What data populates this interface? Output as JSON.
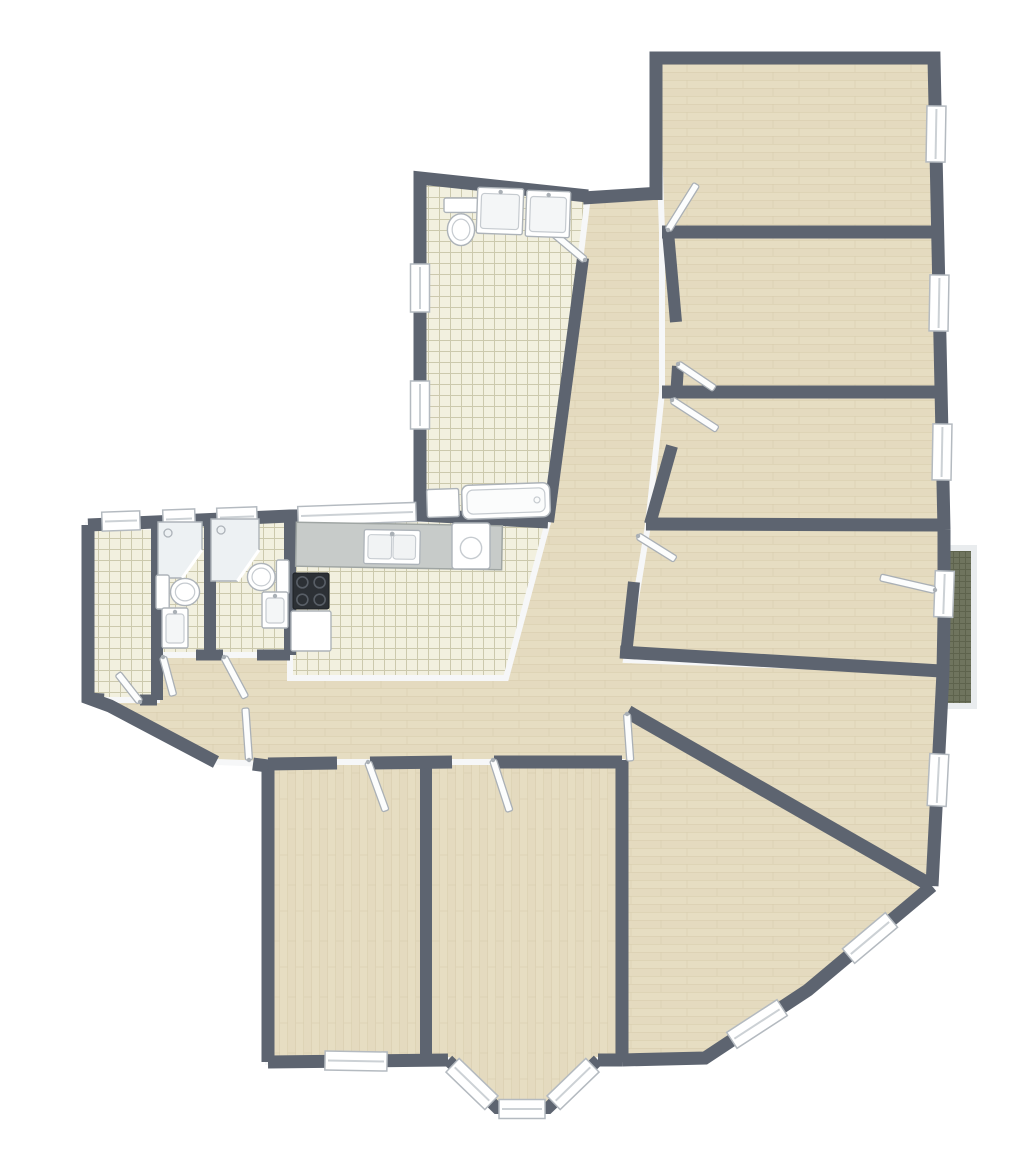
{
  "canvas": {
    "width": 1023,
    "height": 1171
  },
  "palette": {
    "bg": "#ffffff",
    "wall": "#5d6470",
    "baseboard": "#f6f7f8",
    "woodBase": "#e6ddc2",
    "woodLine": "#d6cbac",
    "tileBase": "#f2f0df",
    "tileLine": "#c8c4a8",
    "balconyBase": "#6f745e",
    "balconyLine": "#5e634d",
    "railing": "#e9ecee",
    "windowFill": "#ffffff",
    "windowFrame": "#b4bac0",
    "windowSill": "#ccd1d5",
    "doorFill": "#fcfdfd",
    "doorFrame": "#aab0b6",
    "fixtureFill": "#ffffff",
    "fixtureStroke": "#adb3b9",
    "fixtureDetail": "#c6cbd0",
    "showerFill": "#edf1f3",
    "counter": "#c7cbc9",
    "counterEdge": "#9fa5a3",
    "cooktop": "#2c3035",
    "cooktopRing": "#585e66"
  },
  "floorplan": {
    "rooms": [
      {
        "name": "hallway-living-open-area",
        "floor": "woodH",
        "points": "420,178 588,196 661,193 668,232 676,322 678,366 676,398 668,450 648,530 626,651 941,671 941,712 932,886 808,990 705,1058 598,1060 548,1108 497,1108 448,1060 268,1062 268,764 218,762 110,706 88,700 88,525 157,522 290,516 420,515"
      },
      {
        "name": "bedroom-left",
        "floor": "woodV",
        "points": "268,762 426,762 426,1062 268,1062"
      },
      {
        "name": "bedroom-middle-bay",
        "floor": "woodV",
        "points": "426,762 622,762 622,1060 598,1060 548,1108 497,1108 448,1060 426,1060"
      },
      {
        "name": "room-top-1",
        "floor": "woodH",
        "points": "656,58 934,58 938,232 662,232"
      },
      {
        "name": "room-top-2",
        "floor": "woodH",
        "points": "662,232 938,232 941,392 662,392"
      },
      {
        "name": "room-top-3",
        "floor": "woodH",
        "points": "662,392 941,392 943,525 648,525"
      },
      {
        "name": "room-top-4",
        "floor": "woodH",
        "points": "648,525 943,525 941,671 626,660"
      },
      {
        "name": "bathroom-main",
        "floor": "tile",
        "points": "420,178 588,196 548,522 420,515"
      },
      {
        "name": "utility-room",
        "floor": "tile",
        "points": "88,525 157,527 157,700 88,700"
      },
      {
        "name": "wc-shower-1",
        "floor": "tile",
        "points": "157,521 210,521 210,655 157,655"
      },
      {
        "name": "wc-shower-2",
        "floor": "tile",
        "points": "210,518 290,518 290,655 210,655"
      },
      {
        "name": "kitchen",
        "floor": "tile",
        "points": "290,516 548,522 506,678 290,678"
      }
    ],
    "balcony": {
      "floor": "944,548 974,548 974,706 944,706",
      "railing": "946,548 974,548 974,706 946,706"
    },
    "walls": [
      {
        "name": "ext-bathroom-left-top",
        "w": 13,
        "points": "420,515 420,178 588,196"
      },
      {
        "name": "ext-corridor-top",
        "w": 13,
        "points": "583,198 661,193"
      },
      {
        "name": "ext-rooms-top-right",
        "w": 13,
        "points": "656,200 656,58 934,58 944,530"
      },
      {
        "name": "ext-room4-right-a",
        "w": 13,
        "points": "944,530 944,572"
      },
      {
        "name": "ext-room4-right-b",
        "w": 13,
        "points": "944,617 943,672 941,712 932,886"
      },
      {
        "name": "ext-living-chamfers",
        "w": 13,
        "points": "932,886 808,990 705,1058 622,1060"
      },
      {
        "name": "ext-bed-mid-bottom-right",
        "w": 13,
        "points": "622,1060 598,1060"
      },
      {
        "name": "ext-bay",
        "w": 12,
        "points": "598,1060 548,1108 497,1108 448,1060"
      },
      {
        "name": "ext-bed-left-bottom",
        "w": 13,
        "points": "448,1060 268,1062"
      },
      {
        "name": "ext-bed-left-left",
        "w": 13,
        "points": "268,1062 268,764"
      },
      {
        "name": "ext-hall-stub",
        "w": 13,
        "points": "268,766 253,764"
      },
      {
        "name": "ext-entry-left",
        "w": 13,
        "points": "216,762 110,706 88,698 88,525"
      },
      {
        "name": "ext-top-left",
        "w": 13,
        "points": "88,525 290,516 420,515"
      },
      {
        "name": "int-utility-right",
        "w": 12,
        "points": "157,520 157,700"
      },
      {
        "name": "int-wc-divider",
        "w": 12,
        "points": "210,518 210,655"
      },
      {
        "name": "int-wc2-kitchen",
        "w": 12,
        "points": "290,516 290,655"
      },
      {
        "name": "int-utility-bottom-a",
        "w": 11,
        "points": "88,698 104,699"
      },
      {
        "name": "int-utility-bottom-b",
        "w": 11,
        "points": "140,700 157,700"
      },
      {
        "name": "int-wc1-bottom-a",
        "w": 11,
        "points": "157,655 163,655"
      },
      {
        "name": "int-wc1-bottom-b",
        "w": 11,
        "points": "196,655 210,655"
      },
      {
        "name": "int-wc2-bottom-a",
        "w": 11,
        "points": "210,655 223,655"
      },
      {
        "name": "int-wc2-bottom-b",
        "w": 11,
        "points": "257,655 290,655"
      },
      {
        "name": "int-bathroom-bottom",
        "w": 13,
        "points": "420,515 548,522"
      },
      {
        "name": "int-corridor-left",
        "w": 12,
        "points": "583,258 548,522"
      },
      {
        "name": "int-corridor-right-a",
        "w": 12,
        "points": "668,232 676,322"
      },
      {
        "name": "int-corridor-right-b",
        "w": 12,
        "points": "678,366 676,398"
      },
      {
        "name": "int-corridor-right-c",
        "w": 12,
        "points": "672,446 650,524"
      },
      {
        "name": "int-corridor-right-d",
        "w": 12,
        "points": "634,582 626,655"
      },
      {
        "name": "int-room1-room2",
        "w": 13,
        "points": "662,232 940,232"
      },
      {
        "name": "int-room2-room3",
        "w": 13,
        "points": "662,392 941,392"
      },
      {
        "name": "int-room3-room4",
        "w": 13,
        "points": "646,524 943,525"
      },
      {
        "name": "int-room4-bottom",
        "w": 13,
        "points": "620,652 941,671"
      },
      {
        "name": "int-diagonal-living",
        "w": 14,
        "points": "628,712 932,886"
      },
      {
        "name": "int-living-left",
        "w": 13,
        "points": "622,760 622,1062"
      },
      {
        "name": "int-bed-divider",
        "w": 12,
        "points": "426,762 426,1060"
      },
      {
        "name": "int-hall-bottom-a",
        "w": 13,
        "points": "268,764 337,763"
      },
      {
        "name": "int-hall-bottom-b",
        "w": 13,
        "points": "370,763 452,762"
      },
      {
        "name": "int-hall-bottom-c",
        "w": 13,
        "points": "494,762 622,762"
      }
    ],
    "windows": [
      {
        "name": "bathroom-window-1",
        "cx": 420,
        "cy": 288,
        "len": 48,
        "ang": 90
      },
      {
        "name": "bathroom-window-2",
        "cx": 420,
        "cy": 405,
        "len": 48,
        "ang": 90
      },
      {
        "name": "utility-window",
        "cx": 121,
        "cy": 521,
        "len": 38,
        "ang": -2
      },
      {
        "name": "wc1-window",
        "cx": 179,
        "cy": 519,
        "len": 32,
        "ang": -2
      },
      {
        "name": "wc2-window",
        "cx": 237,
        "cy": 517,
        "len": 40,
        "ang": -2
      },
      {
        "name": "kitchen-window",
        "cx": 357,
        "cy": 514,
        "len": 118,
        "ang": -2
      },
      {
        "name": "room1-window",
        "cx": 936,
        "cy": 134,
        "len": 56,
        "ang": 91
      },
      {
        "name": "room2-window",
        "cx": 939,
        "cy": 303,
        "len": 56,
        "ang": 91
      },
      {
        "name": "room3-window",
        "cx": 942,
        "cy": 452,
        "len": 56,
        "ang": 91
      },
      {
        "name": "balcony-door-glass",
        "cx": 944,
        "cy": 594,
        "len": 46,
        "ang": 92
      },
      {
        "name": "dining-window",
        "cx": 938,
        "cy": 780,
        "len": 52,
        "ang": 93
      },
      {
        "name": "living-window-1",
        "cx": 870,
        "cy": 938,
        "len": 56,
        "ang": 140
      },
      {
        "name": "living-window-2",
        "cx": 757,
        "cy": 1024,
        "len": 60,
        "ang": 147
      },
      {
        "name": "bedroom-left-window",
        "cx": 356,
        "cy": 1061,
        "len": 62,
        "ang": 1
      },
      {
        "name": "bay-window-left",
        "cx": 472,
        "cy": 1084,
        "len": 54,
        "ang": 44
      },
      {
        "name": "bay-window-center",
        "cx": 522,
        "cy": 1109,
        "len": 46,
        "ang": 0
      },
      {
        "name": "bay-window-right",
        "cx": 573,
        "cy": 1084,
        "len": 54,
        "ang": -44
      }
    ],
    "doors": [
      {
        "name": "bathroom-door",
        "hx": 585,
        "hy": 260,
        "ang": -140,
        "len": 52
      },
      {
        "name": "room1-door",
        "hx": 668,
        "hy": 230,
        "ang": -58,
        "len": 54
      },
      {
        "name": "room2-door",
        "hx": 678,
        "hy": 364,
        "ang": 34,
        "len": 44
      },
      {
        "name": "room3-door",
        "hx": 672,
        "hy": 400,
        "ang": 33,
        "len": 54
      },
      {
        "name": "room4-door",
        "hx": 638,
        "hy": 536,
        "ang": 32,
        "len": 44
      },
      {
        "name": "balcony-door",
        "hx": 935,
        "hy": 590,
        "ang": 193,
        "len": 56
      },
      {
        "name": "living-room-door",
        "hx": 627,
        "hy": 714,
        "ang": 86,
        "len": 47
      },
      {
        "name": "bedroom-left-door",
        "hx": 368,
        "hy": 762,
        "ang": 70,
        "len": 52
      },
      {
        "name": "bedroom-mid-door",
        "hx": 493,
        "hy": 760,
        "ang": 72,
        "len": 54
      },
      {
        "name": "wc1-door",
        "hx": 163,
        "hy": 657,
        "ang": 75,
        "len": 40
      },
      {
        "name": "wc2-door",
        "hx": 224,
        "hy": 657,
        "ang": 62,
        "len": 46
      },
      {
        "name": "utility-door",
        "hx": 140,
        "hy": 702,
        "ang": -128,
        "len": 36
      },
      {
        "name": "entry-door",
        "hx": 249,
        "hy": 760,
        "ang": -94,
        "len": 52
      }
    ],
    "fixtures": [
      {
        "type": "toilet",
        "name": "bathroom-toilet",
        "cx": 461,
        "cy": 222,
        "w": 34,
        "h": 48,
        "rot": 0
      },
      {
        "type": "vanity",
        "name": "bathroom-vanity-1",
        "cx": 500,
        "cy": 211,
        "w": 46,
        "h": 46,
        "rot": 2
      },
      {
        "type": "vanity",
        "name": "bathroom-vanity-2",
        "cx": 548,
        "cy": 214,
        "w": 44,
        "h": 46,
        "rot": 2
      },
      {
        "type": "tub",
        "name": "bathroom-bathtub",
        "cx": 506,
        "cy": 501,
        "w": 88,
        "h": 34,
        "rot": -2
      },
      {
        "type": "cabinet",
        "name": "bathroom-cabinet",
        "cx": 443,
        "cy": 503,
        "w": 32,
        "h": 28,
        "rot": -2
      },
      {
        "type": "shower",
        "name": "wc1-shower",
        "cx": 180,
        "cy": 550,
        "w": 44,
        "h": 56,
        "rot": 0
      },
      {
        "type": "toilet",
        "name": "wc1-toilet",
        "cx": 178,
        "cy": 592,
        "w": 34,
        "h": 44,
        "rot": -90
      },
      {
        "type": "vanity",
        "name": "wc1-vanity",
        "cx": 175,
        "cy": 628,
        "w": 26,
        "h": 40,
        "rot": 0
      },
      {
        "type": "shower",
        "name": "wc2-shower",
        "cx": 235,
        "cy": 550,
        "w": 48,
        "h": 62,
        "rot": 0
      },
      {
        "type": "toilet",
        "name": "wc2-toilet",
        "cx": 268,
        "cy": 577,
        "w": 34,
        "h": 42,
        "rot": 90
      },
      {
        "type": "vanity",
        "name": "wc2-vanity",
        "cx": 275,
        "cy": 610,
        "w": 26,
        "h": 36,
        "rot": 0
      },
      {
        "type": "counter",
        "name": "kitchen-counter",
        "cx": 399,
        "cy": 546,
        "w": 206,
        "h": 44,
        "rot": 1
      },
      {
        "type": "ksink",
        "name": "kitchen-sink",
        "cx": 392,
        "cy": 547,
        "w": 56,
        "h": 34,
        "rot": 1
      },
      {
        "type": "washer",
        "name": "kitchen-washer",
        "cx": 471,
        "cy": 546,
        "w": 38,
        "h": 46,
        "rot": 0
      },
      {
        "type": "cooktop",
        "name": "kitchen-cooktop",
        "cx": 311,
        "cy": 591,
        "w": 36,
        "h": 36,
        "rot": 0
      },
      {
        "type": "cabinet",
        "name": "kitchen-cabinet",
        "cx": 311,
        "cy": 631,
        "w": 40,
        "h": 40,
        "rot": 0
      }
    ]
  }
}
